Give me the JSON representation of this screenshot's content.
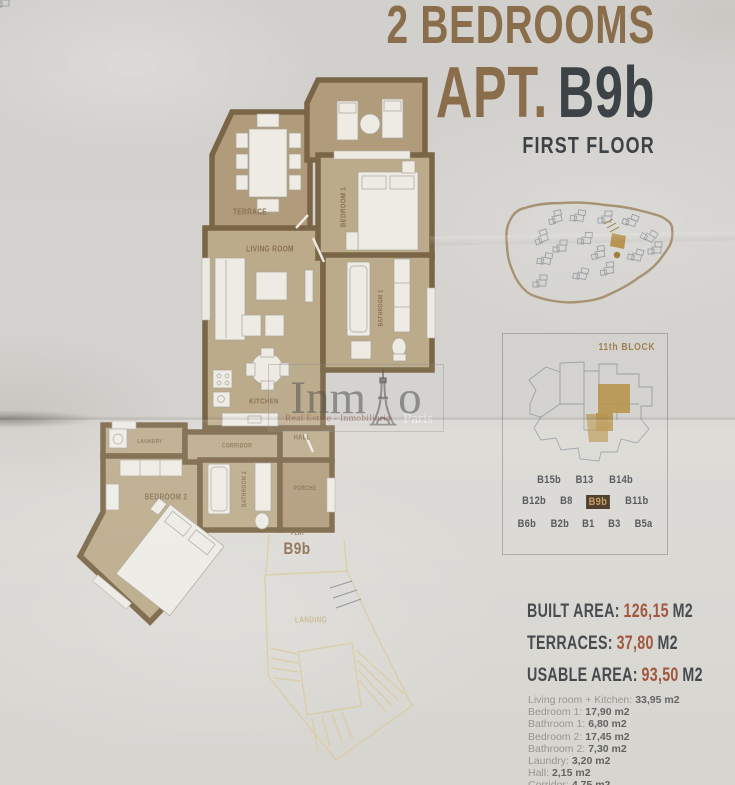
{
  "palette": {
    "accent": "#8a6e4b",
    "dark": "#3c4245",
    "wall": "#7a6546",
    "floor": "#bcab8b",
    "terrace": "#b09b7b",
    "furn": "#edebe4",
    "red": "#9c4f35",
    "label": "#8a7050",
    "landing": "#d9cca4",
    "panelLine": "#9aa0a4",
    "siteLine": "#a79272",
    "gold": "#b8954e",
    "badgeBg": "#3f2f1c",
    "badgeText": "#c59455",
    "listName": "#92928f",
    "listVal": "#5e5e5c"
  },
  "header": {
    "title_line": "2 BEDROOMS",
    "apt_prefix": "APT.",
    "apt_code": "B9b",
    "floor": "FIRST FLOOR"
  },
  "plan": {
    "rooms": {
      "terrace": "TERRACE",
      "living_room": "LIVING ROOM",
      "kitchen": "KITCHEN",
      "bedroom1": "BEDROOM 1",
      "bathroom1": "BATHROOM 1",
      "laundry": "LAUNDRY",
      "corridor": "CORRIDOR",
      "bedroom2": "BEDROOM 2",
      "bathroom2": "BATHROOM 2",
      "hall": "HALL",
      "porche": "PORCHE",
      "landing": "LANDING"
    },
    "flat_label": "FLAT",
    "flat_code": "B9b"
  },
  "block_panel": {
    "title": "11th BLOCK",
    "rows": [
      [
        "B15b",
        "B13",
        "B14b"
      ],
      [
        "B12b",
        "B8",
        "B9b",
        "B11b"
      ],
      [
        "B6b",
        "B2b",
        "B1",
        "B3",
        "B5a"
      ]
    ],
    "highlighted": "B9b"
  },
  "areas": [
    {
      "label": "BUILT AREA:",
      "value": "126,15",
      "unit": "M2"
    },
    {
      "label": "TERRACES:",
      "value": "37,80",
      "unit": "M2"
    },
    {
      "label": "USABLE AREA:",
      "value": "93,50",
      "unit": "M2"
    }
  ],
  "room_areas": [
    {
      "name": "Living room + Kitchen:",
      "value": "33,95 m2"
    },
    {
      "name": "Bedroom 1:",
      "value": "17,90 m2"
    },
    {
      "name": "Bathroom 1:",
      "value": "6,80 m2"
    },
    {
      "name": "Bedroom 2:",
      "value": "17,45 m2"
    },
    {
      "name": "Bathroom 2:",
      "value": "7,30 m2"
    },
    {
      "name": "Laundry:",
      "value": "3,20 m2"
    },
    {
      "name": "Hall:",
      "value": "2,15 m2"
    },
    {
      "name": "Corridor:",
      "value": "4,75 m2"
    }
  ],
  "watermark": {
    "brand_prefix": "Inm",
    "brand_suffix": "o",
    "tagline": "Real Estate - Inmobiliaria",
    "city": "Paris"
  }
}
